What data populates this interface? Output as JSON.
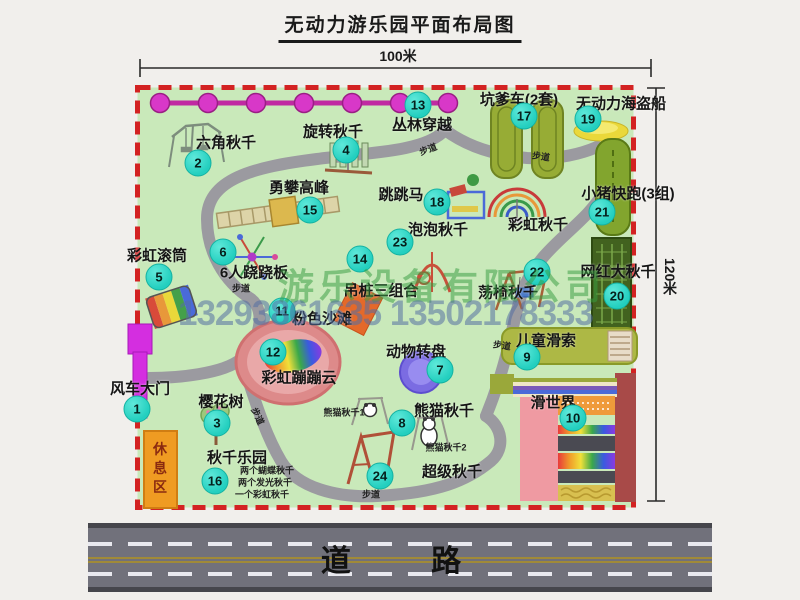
{
  "title": "无动力游乐园平面布局图",
  "dimensions": {
    "width": "100米",
    "height": "120米"
  },
  "watermark": {
    "company": "游乐设备有限公司",
    "phone": "13293861635 13502178333"
  },
  "road_label": "道 路",
  "rest_area_label": "休息区",
  "walkway_label": "步道",
  "attractions": {
    "a1": {
      "num": "1",
      "label": "风车大门"
    },
    "a2": {
      "num": "2",
      "label": "六角秋千"
    },
    "a3": {
      "num": "3",
      "label": "樱花树"
    },
    "a4": {
      "num": "4",
      "label": "旋转秋千"
    },
    "a5": {
      "num": "5",
      "label": "彩虹滚筒"
    },
    "a6": {
      "num": "6",
      "label": "6人跷跷板"
    },
    "a7": {
      "num": "7",
      "label": "动物转盘"
    },
    "a8": {
      "num": "8",
      "label": "熊猫秋千",
      "sub1": "熊猫秋千1",
      "sub2": "熊猫秋千2"
    },
    "a9": {
      "num": "9",
      "label": "儿童滑索"
    },
    "a10": {
      "num": "10",
      "label": "滑世界"
    },
    "a11": {
      "num": "11",
      "label": "粉色沙滩"
    },
    "a12": {
      "num": "12",
      "label": "彩虹蹦蹦云"
    },
    "a13": {
      "num": "13",
      "label": "丛林穿越"
    },
    "a14": {
      "num": "14",
      "label": "吊桩三组合"
    },
    "a15": {
      "num": "15",
      "label": "勇攀高峰"
    },
    "a16": {
      "num": "16",
      "label": "秋千乐园",
      "sub1": "两个蝴蝶秋千",
      "sub2": "两个发光秋千",
      "sub3": "一个彩虹秋千"
    },
    "a17": {
      "num": "17",
      "label": "坑爹车(2套)"
    },
    "a18": {
      "num": "18",
      "label": "跳跳马"
    },
    "a19": {
      "num": "19",
      "label": "无动力海盗船"
    },
    "a20": {
      "num": "20",
      "label": "网红大秋千"
    },
    "a21": {
      "num": "21",
      "label": "小猪快跑(3组)"
    },
    "a22": {
      "num": "22",
      "label": "荡椅秋千"
    },
    "a23": {
      "num": "23",
      "label": "泡泡秋千"
    },
    "a24": {
      "num": "24",
      "label": "超级秋千"
    },
    "rainbow_swing": {
      "label": "彩虹秋千"
    }
  },
  "colors": {
    "park_green": "#c9e9ba",
    "boundary_red": "#d32222",
    "badge_teal": "#23cfbf",
    "gate_magenta": "#d42ee0",
    "rest_orange": "#ef9b22",
    "road_gray": "#71717b"
  }
}
